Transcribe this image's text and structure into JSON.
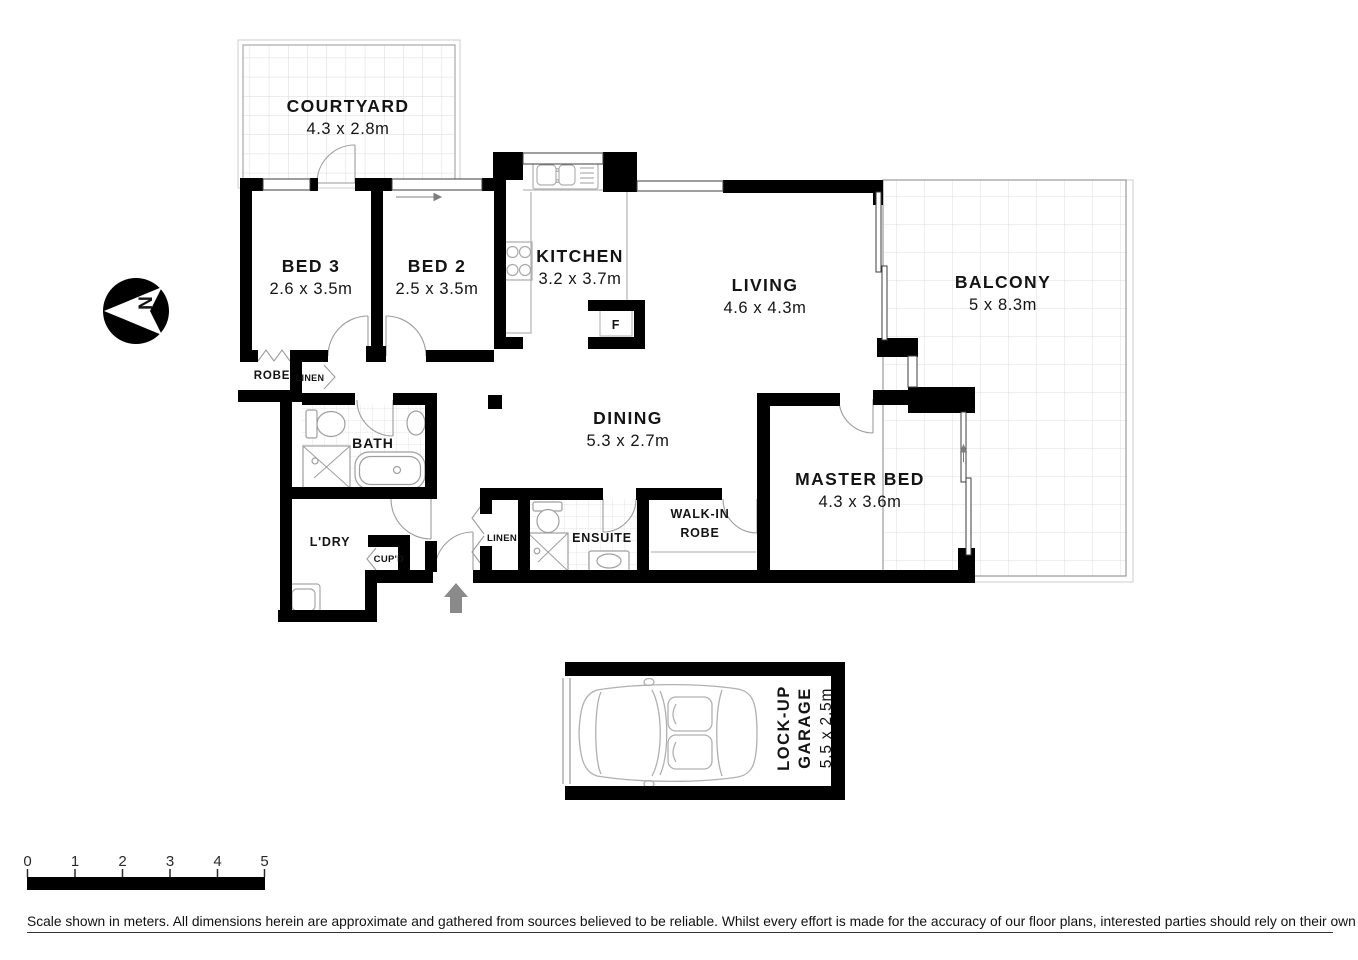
{
  "rooms": [
    {
      "name": "COURTYARD",
      "dims": "4.3 x 2.8m"
    },
    {
      "name": "BED 3",
      "dims": "2.6 x 3.5m"
    },
    {
      "name": "BED 2",
      "dims": "2.5 x 3.5m"
    },
    {
      "name": "KITCHEN",
      "dims": "3.2 x 3.7m"
    },
    {
      "name": "LIVING",
      "dims": "4.6 x 4.3m"
    },
    {
      "name": "BALCONY",
      "dims": "5 x 8.3m"
    },
    {
      "name": "DINING",
      "dims": "5.3 x 2.7m"
    },
    {
      "name": "MASTER BED",
      "dims": "4.3 x 3.6m"
    }
  ],
  "labels": {
    "robe": "ROBE",
    "linen_hall": "LINEN",
    "bath": "BATH",
    "laundry": "L'DRY",
    "cupboard": "CUP'D",
    "linen_entry": "LINEN",
    "ensuite": "ENSUITE",
    "walk_in_line1": "WALK-IN",
    "walk_in_line2": "ROBE",
    "fridge": "F"
  },
  "garage": {
    "name_line1": "LOCK-UP",
    "name_line2": "GARAGE",
    "dims": "5.5 x 2.5m"
  },
  "compass": {
    "north": "N"
  },
  "scalebar": {
    "ticks": [
      "0",
      "1",
      "2",
      "3",
      "4",
      "5"
    ]
  },
  "footer": {
    "disclaimer": "Scale shown in meters. All dimensions herein are approximate and gathered from sources believed to be  reliable. Whilst every effort is made for the accuracy of our floor plans, interested parties should rely on their own enquiries."
  },
  "colors": {
    "wall": "#000000",
    "fixture": "#b0b0b0",
    "tile": "#d6d6d6",
    "entry_arrow": "#8a8a8a"
  }
}
